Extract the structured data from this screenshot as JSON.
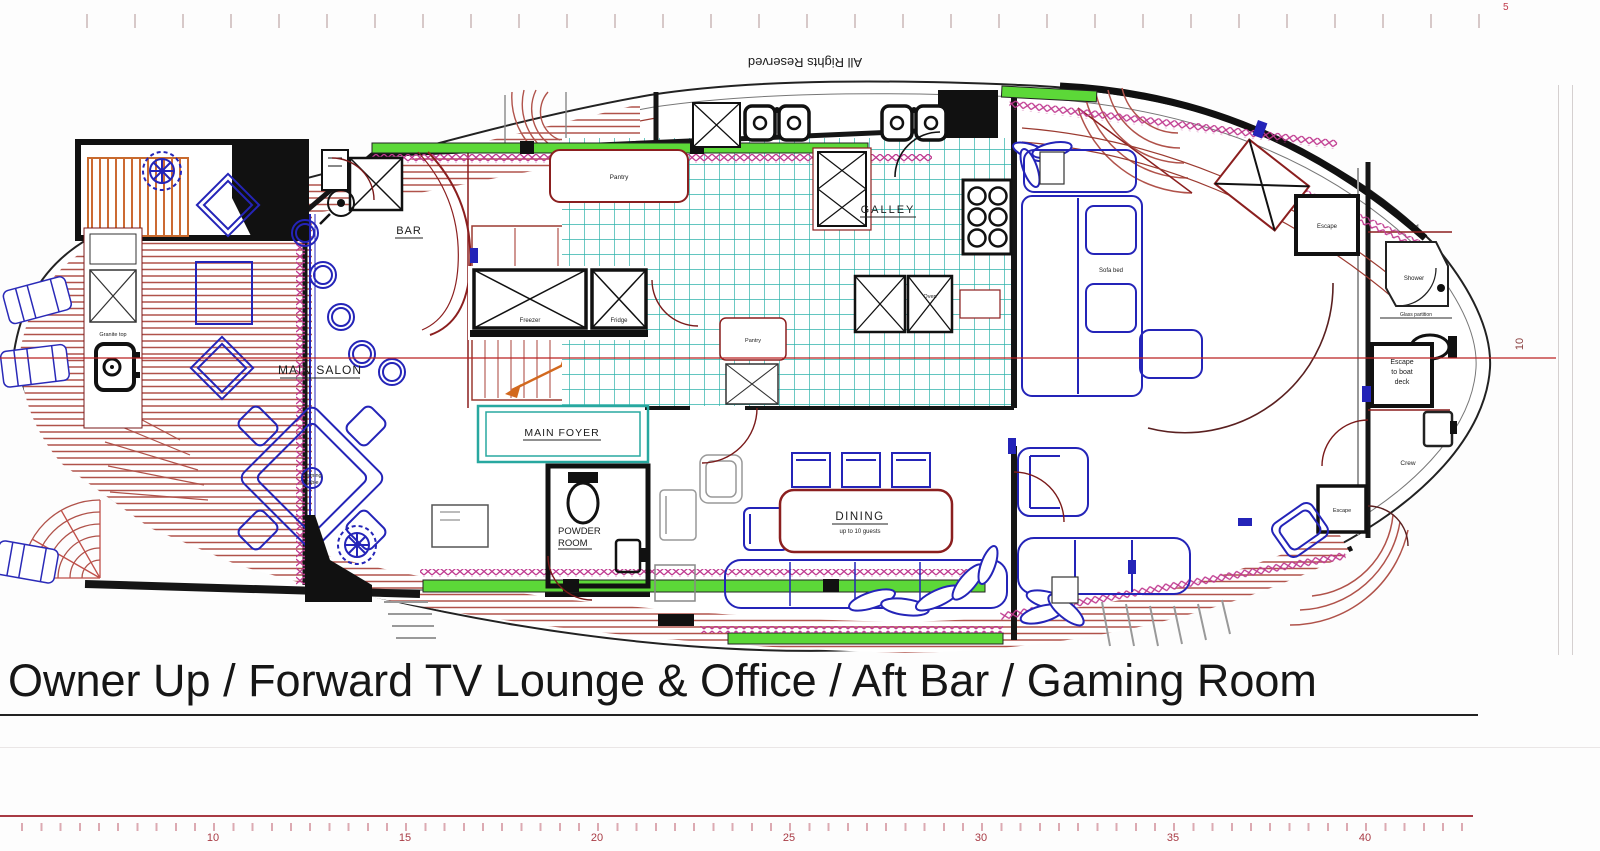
{
  "watermark": "All Rights Reserved",
  "title": {
    "text": "Owner Up / Forward TV Lounge & Office / Aft Bar / Gaming Room"
  },
  "rooms": {
    "main_salon": "MAIN SALON",
    "bar": "BAR",
    "galley": "GALLEY",
    "main_foyer": "MAIN FOYER",
    "powder_1": "POWDER",
    "powder_2": "ROOM",
    "dining": "DINING",
    "dining_capacity": "up to 10 guests",
    "crew": "Crew"
  },
  "fixtures": {
    "freezer": "Freezer",
    "fridge": "Fridge",
    "pantry_upper": "Pantry",
    "pantry_mid": "Pantry",
    "oven": "Oven",
    "gaming_table_1": "Gaming",
    "gaming_table_2": "Table",
    "sofa_bed": "Sofa bed",
    "escape_aft": "Escape",
    "escape_mid": "Escape",
    "escape_hatch_1": "Escape",
    "escape_hatch_2": "to boat",
    "escape_hatch_3": "deck",
    "shower": "Shower",
    "glass_partition": "Glass partition",
    "granite_top": "Granite top",
    "bed": "bed"
  },
  "top_ruler": {
    "number": "5"
  },
  "side_ruler": {
    "number": "10"
  },
  "bottom_ruler": {
    "numbers": [
      "10",
      "15",
      "20",
      "25",
      "30",
      "35",
      "40"
    ],
    "start_x": 213,
    "spacing": 192
  },
  "colors": {
    "wall": "#151515",
    "red_line": "#8b1f1f",
    "teak": "#b0524a",
    "blue": "#2424b8",
    "teal": "#28a8a0",
    "green": "#5cd838",
    "magenta": "#c03a90",
    "orange": "#d2691e",
    "ruler_red": "#a83a44"
  }
}
